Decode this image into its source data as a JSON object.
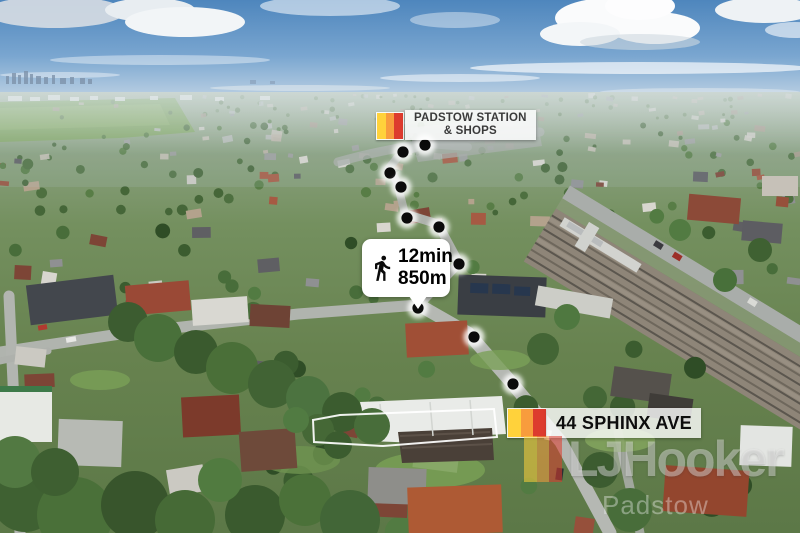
{
  "labels": {
    "station": {
      "line1": "PADSTOW STATION",
      "line2": "& SHOPS"
    },
    "walk": {
      "time": "12min",
      "distance": "850m"
    },
    "property": {
      "text": "44 SPHINX AVE"
    }
  },
  "watermark": {
    "brand": "LJHooker",
    "office": "Padstow"
  },
  "brand": {
    "flag_colors": {
      "yellow": "#FFD23B",
      "orange": "#F89C3D",
      "red": "#DD3B2E"
    }
  },
  "route": {
    "dots": [
      [
        425,
        145
      ],
      [
        403,
        152
      ],
      [
        390,
        173
      ],
      [
        401,
        187
      ],
      [
        407,
        218
      ],
      [
        439,
        227
      ],
      [
        459,
        264
      ],
      [
        418,
        308
      ],
      [
        474,
        337
      ],
      [
        513,
        384
      ]
    ]
  },
  "property_boundary": {
    "points": "313,420 340,415 494,409 497,437 383,446 314,442"
  }
}
